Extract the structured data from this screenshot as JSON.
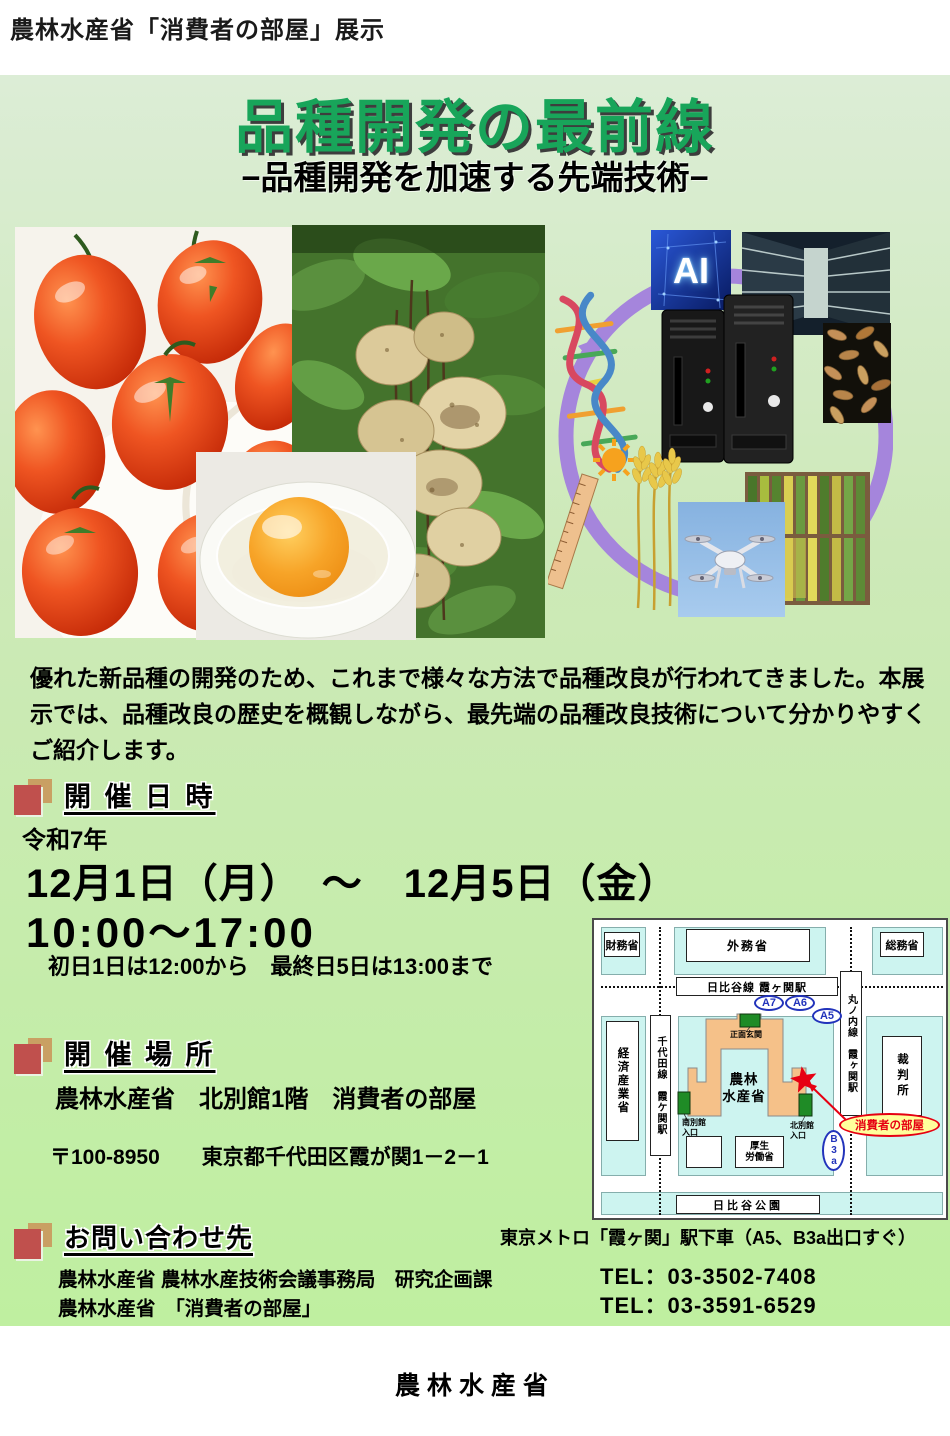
{
  "page": {
    "header_label": "農林水産省「消費者の部屋」展示",
    "footer_label": "農林水産省"
  },
  "poster": {
    "title": "品種開発の最前線",
    "subtitle": "−品種開発を加速する先端技術−",
    "intro": "優れた新品種の開発のため、これまで様々な方法で品種改良が行われてきました。本展示では、品種改良の歴史を概観しながら、最先端の品種改良技術について分かりやすくご紹介します。",
    "colors": {
      "title_green": "#18a55a",
      "poster_green_top": "#dcedd6",
      "poster_green_bottom": "#bfefa0",
      "bullet_red": "#c0504d",
      "bullet_tan": "#c9a063",
      "map_building_orange": "#f5c189",
      "map_entrance_green": "#1f8b26",
      "map_block_cyan": "#cdf4f0",
      "highlight_yellow": "#ffff9c",
      "exit_blue": "#2233bb",
      "star_red": "#e60012"
    }
  },
  "schedule": {
    "heading": "開 催 日 時",
    "era_year": "令和7年",
    "date_range": "12月1日（月）　～　12月5日（金）",
    "time_range": "10:00～17:00",
    "note": "初日1日は12:00から　最終日5日は13:00まで"
  },
  "venue": {
    "heading": "開 催 場 所",
    "place": "農林水産省　北別館1階　消費者の部屋",
    "address": "〒100-8950　　東京都千代田区霞が関1－2－1"
  },
  "contact": {
    "heading": "お問い合わせ先",
    "access_note": "東京メトロ「霞ヶ関」駅下車（A5、B3a出口すぐ）",
    "lines": [
      {
        "name": "農林水産省 農林水産技術会議事務局　研究企画課",
        "tel": "TEL：03-3502-7408"
      },
      {
        "name": "農林水産省　「消費者の部屋」",
        "tel": "TEL：03-3591-6529"
      }
    ]
  },
  "collage": {
    "ai_label": "AI"
  },
  "map": {
    "zaimusho": "財務省",
    "gaimusho": "外務省",
    "somusho": "総務省",
    "hibiya_line": "日比谷線 霞ヶ関駅",
    "exit_a7": "A7",
    "exit_a6": "A6",
    "exit_a5": "A5",
    "marunouchi_line": "丸ノ内線　霞ヶ関駅",
    "chiyoda_line": "千代田線　霞ケ関駅",
    "keizai_sangyo": "経済産業省",
    "saibansho": "裁判所",
    "shomen_genkan": "正面玄関",
    "maff_building": "農林\n水産省",
    "minami_bekkan": "南別館\n入口",
    "kita_bekkan": "北別館\n入口",
    "kosei_rodo": "厚生\n労働省",
    "exit_b3a": "B3a",
    "consumer_room": "消費者の部屋",
    "hibiya_park": "日比谷公園"
  }
}
